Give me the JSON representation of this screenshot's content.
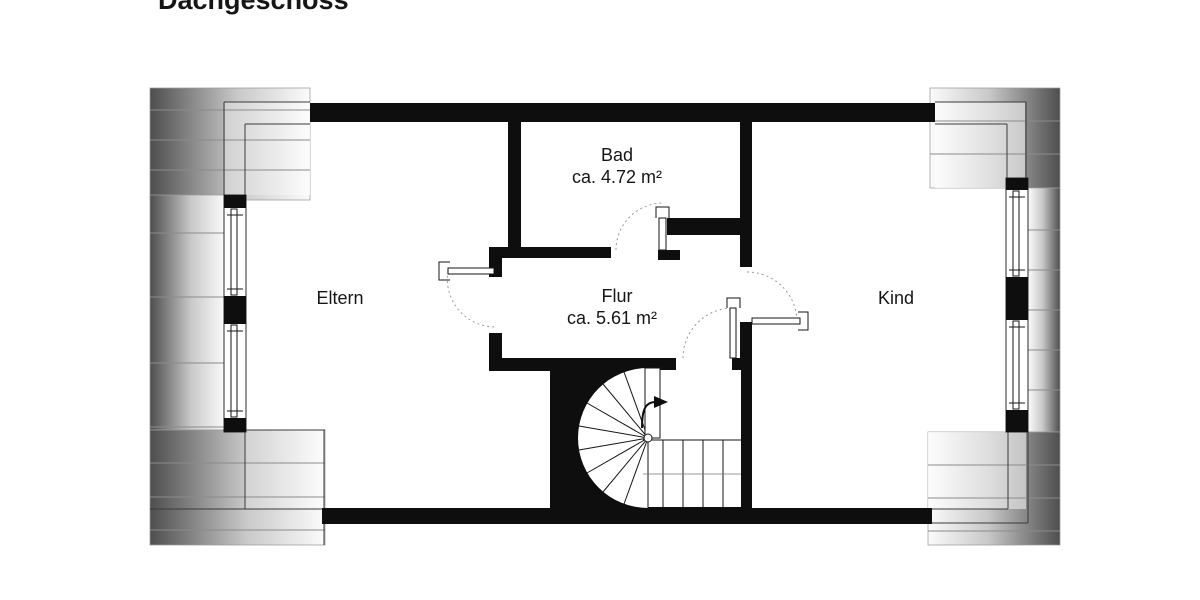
{
  "title": "Dachgeschoss",
  "floor": {
    "rooms": [
      {
        "id": "eltern",
        "label": "Eltern"
      },
      {
        "id": "bad",
        "label": "Bad",
        "area": "ca. 4.72 m²"
      },
      {
        "id": "flur",
        "label": "Flur",
        "area": "ca. 5.61 m²"
      },
      {
        "id": "kind",
        "label": "Kind"
      }
    ],
    "stairs": {
      "type": "winder-staircase",
      "direction": "up"
    },
    "windows": {
      "left_wall": 2,
      "right_wall": 2
    },
    "door_count": 4
  },
  "colors": {
    "wall": "#0e0e0e",
    "background": "#ffffff",
    "roof_slope_shade": "#4e4e4e",
    "door_swing_arc": "#9b9b9b"
  }
}
